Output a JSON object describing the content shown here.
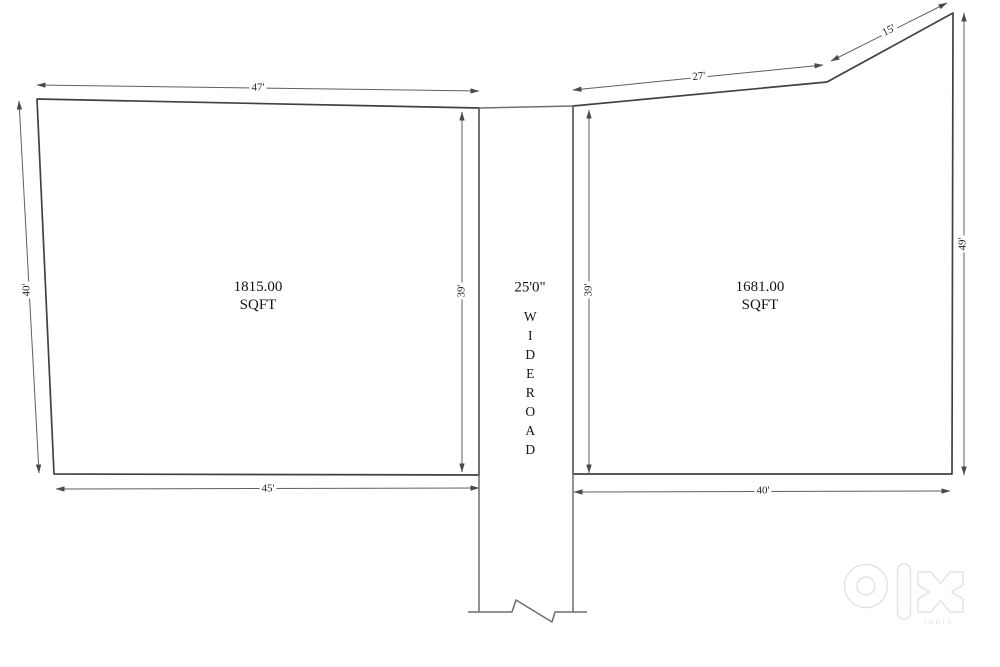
{
  "plan": {
    "left_plot": {
      "area_value": "1815.00",
      "area_unit": "SQFT",
      "dim_top": "47'",
      "dim_left": "40'",
      "dim_right": "39'",
      "dim_bottom": "45'"
    },
    "road": {
      "width_label": "25'0\"",
      "name_word1": "WIDE",
      "name_word2": "ROAD"
    },
    "right_plot": {
      "area_value": "1681.00",
      "area_unit": "SQFT",
      "dim_top_left": "27'",
      "dim_top_right": "15'",
      "dim_left": "39'",
      "dim_right": "49'",
      "dim_bottom": "40'"
    },
    "watermark": {
      "brand": "olx",
      "region": "INDIA"
    },
    "colors": {
      "boundary": "#414141",
      "road_line": "#6e6e6e",
      "dimension_line": "#5f5f5f",
      "background": "#ffffff",
      "watermark_outline": "#e3e3e3"
    }
  }
}
